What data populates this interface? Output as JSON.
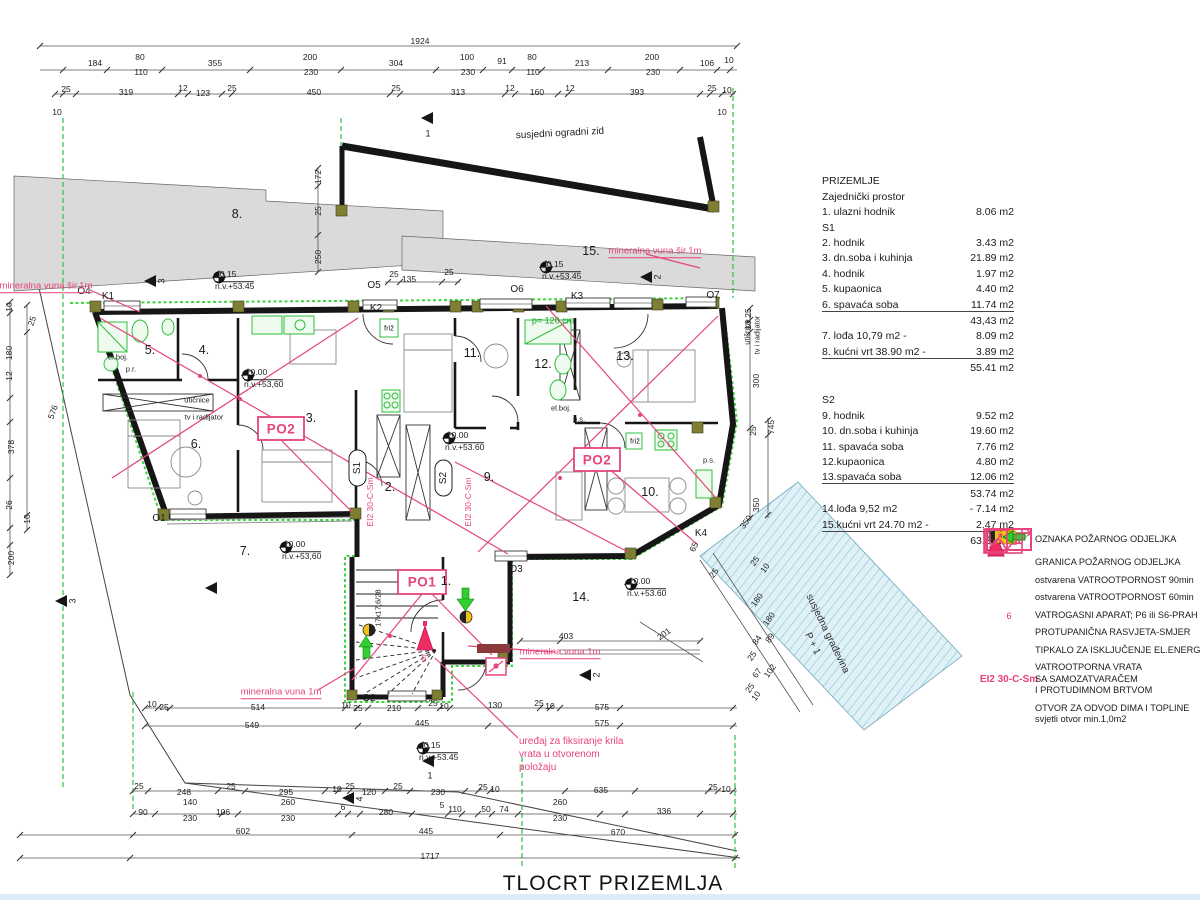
{
  "title": "TLOCRT PRIZEMLJA",
  "colors": {
    "pink": "#e5447c",
    "green": "#2fbf3f",
    "wall": "#161616",
    "gray_fill": "#dadada",
    "blue_fill": "#dff0f7",
    "blue_hatch": "#8cc3d6",
    "yellow": "#f2c117",
    "red": "#ec2e63",
    "olive": "#7f7f33"
  },
  "schedule": {
    "rows": [
      {
        "k": "h",
        "n": "PRIZEMLJE",
        "a": ""
      },
      {
        "k": "s",
        "n": "Zajednički prostor",
        "a": ""
      },
      {
        "k": "r",
        "n": "1. ulazni hodnik",
        "a": "8.06 m2"
      },
      {
        "k": "s",
        "n": "S1",
        "a": ""
      },
      {
        "k": "r",
        "n": "2. hodnik",
        "a": "3.43 m2"
      },
      {
        "k": "r",
        "n": "3. dn.soba i kuhinja",
        "a": "21.89 m2"
      },
      {
        "k": "r",
        "n": "4. hodnik",
        "a": "1.97 m2"
      },
      {
        "k": "r",
        "n": "5. kupaonica",
        "a": "4.40 m2"
      },
      {
        "k": "r",
        "n": "6. spavaća soba",
        "a": "11.74 m2",
        "u": 1
      },
      {
        "k": "t",
        "n": "",
        "a": "43,43 m2"
      },
      {
        "k": "r",
        "n": "7. lođa 10,79 m2 -",
        "a": "8.09 m2"
      },
      {
        "k": "r",
        "n": "8. kućni vrt 38.90 m2 -",
        "a": "3.89 m2",
        "u": 1
      },
      {
        "k": "t",
        "n": "",
        "a": "55.41 m2"
      },
      {
        "k": "gap",
        "n": "",
        "a": ""
      },
      {
        "k": "s",
        "n": "S2",
        "a": ""
      },
      {
        "k": "r",
        "n": "9. hodnik",
        "a": "9.52 m2"
      },
      {
        "k": "r",
        "n": "10. dn.soba i kuhinja",
        "a": "19.60 m2"
      },
      {
        "k": "r",
        "n": "11. spavaća soba",
        "a": "7.76 m2"
      },
      {
        "k": "r",
        "n": "12.kupaonica",
        "a": "4.80 m2"
      },
      {
        "k": "r",
        "n": "13.spavaća soba",
        "a": "12.06 m2",
        "u": 1
      },
      {
        "k": "t",
        "n": "",
        "a": "53.74 m2"
      },
      {
        "k": "r",
        "n": "14.lođa 9,52 m2",
        "a": "- 7.14 m2"
      },
      {
        "k": "r",
        "n": "15.kućni vrt 24.70 m2 -",
        "a": "2.47 m2",
        "u": 1
      },
      {
        "k": "t",
        "n": "",
        "a": "63.35 m2"
      }
    ]
  },
  "legend": {
    "items": [
      {
        "icon": "po1",
        "box_label": "PO1",
        "lines": [
          "OZNAKA POŽARNOG ODJELJKA"
        ]
      },
      {
        "icon": "boundary",
        "lines": [
          "GRANICA POŽARNOG ODJELJKA"
        ]
      },
      {
        "icon": "fire90",
        "lines": [
          "ostvarena VATROOTPORNOST 90min"
        ]
      },
      {
        "icon": "fire60",
        "lines": [
          "ostvarena  VATROOTPORNOST 60min"
        ]
      },
      {
        "icon": "extinguisher",
        "sub": "6",
        "lines": [
          "VATROGASNI APARAT; P6 ili S6-PRAH"
        ]
      },
      {
        "icon": "panic",
        "lines": [
          "PROTUPANIČNA RASVJETA-SMJER"
        ]
      },
      {
        "icon": "switch",
        "lines": [
          "TIPKALO ZA ISKLJUČENJE EL.ENERGIJE"
        ]
      },
      {
        "icon": "code",
        "code": "EI2 30-C-Sm",
        "lines": [
          "VATROOTPORNA VRATA",
          "SA SAMOZATVARAČEM",
          "I PROTUDIMNOM BRTVOM"
        ]
      },
      {
        "icon": "vent",
        "lines": [
          "OTVOR ZA ODVOD DIMA I TOPLINE",
          "svjetli otvor min.1,0m2"
        ]
      }
    ]
  },
  "elevations": [
    {
      "v": "-0.15",
      "nv": "n.v.+53.45",
      "x": 218,
      "y": 281
    },
    {
      "v": "-0.15",
      "nv": "n.v.+53.45",
      "x": 545,
      "y": 271
    },
    {
      "v": "±0.00",
      "nv": "n.v.+53,60",
      "x": 247,
      "y": 379
    },
    {
      "v": "±0.00",
      "nv": "n.v.+53.60",
      "x": 448,
      "y": 442
    },
    {
      "v": "±0.00",
      "nv": "n.v.+53.60",
      "x": 630,
      "y": 588
    },
    {
      "v": "±0.00",
      "nv": "n.v.+53,60",
      "x": 285,
      "y": 551
    },
    {
      "v": "-0.15",
      "nv": "n.v.+53.45",
      "x": 422,
      "y": 752
    }
  ],
  "plan_labels": [
    {
      "t": "1924",
      "x": 420,
      "y": 41,
      "c": "d"
    },
    {
      "t": "184",
      "x": 95,
      "y": 63,
      "c": "d"
    },
    {
      "t": "80",
      "x": 140,
      "y": 57,
      "c": "d"
    },
    {
      "t": "110",
      "x": 141,
      "y": 72,
      "c": "d"
    },
    {
      "t": "355",
      "x": 215,
      "y": 63,
      "c": "d"
    },
    {
      "t": "200",
      "x": 310,
      "y": 57,
      "c": "d"
    },
    {
      "t": "230",
      "x": 311,
      "y": 72,
      "c": "d"
    },
    {
      "t": "304",
      "x": 396,
      "y": 63,
      "c": "d"
    },
    {
      "t": "100",
      "x": 467,
      "y": 57,
      "c": "d"
    },
    {
      "t": "230",
      "x": 468,
      "y": 72,
      "c": "d"
    },
    {
      "t": "91",
      "x": 502,
      "y": 61,
      "c": "d"
    },
    {
      "t": "80",
      "x": 532,
      "y": 57,
      "c": "d"
    },
    {
      "t": "110",
      "x": 533,
      "y": 72,
      "c": "d"
    },
    {
      "t": "213",
      "x": 582,
      "y": 63,
      "c": "d"
    },
    {
      "t": "200",
      "x": 652,
      "y": 57,
      "c": "d"
    },
    {
      "t": "230",
      "x": 653,
      "y": 72,
      "c": "d"
    },
    {
      "t": "106",
      "x": 707,
      "y": 63,
      "c": "d"
    },
    {
      "t": "10",
      "x": 729,
      "y": 60,
      "c": "d"
    },
    {
      "t": "25",
      "x": 66,
      "y": 89,
      "c": "d"
    },
    {
      "t": "319",
      "x": 126,
      "y": 92,
      "c": "d"
    },
    {
      "t": "12",
      "x": 183,
      "y": 88,
      "c": "d"
    },
    {
      "t": "123",
      "x": 203,
      "y": 93,
      "c": "d"
    },
    {
      "t": "25",
      "x": 232,
      "y": 88,
      "c": "d"
    },
    {
      "t": "450",
      "x": 314,
      "y": 92,
      "c": "d"
    },
    {
      "t": "25",
      "x": 396,
      "y": 88,
      "c": "d"
    },
    {
      "t": "313",
      "x": 458,
      "y": 92,
      "c": "d"
    },
    {
      "t": "12",
      "x": 510,
      "y": 88,
      "c": "d"
    },
    {
      "t": "160",
      "x": 537,
      "y": 92,
      "c": "d"
    },
    {
      "t": "12",
      "x": 570,
      "y": 88,
      "c": "d"
    },
    {
      "t": "393",
      "x": 637,
      "y": 92,
      "c": "d"
    },
    {
      "t": "25",
      "x": 712,
      "y": 88,
      "c": "d"
    },
    {
      "t": "10",
      "x": 727,
      "y": 90,
      "c": "d"
    },
    {
      "t": "10",
      "x": 57,
      "y": 112,
      "c": "d"
    },
    {
      "t": "10",
      "x": 722,
      "y": 112,
      "c": "d"
    },
    {
      "t": "25",
      "x": 139,
      "y": 786,
      "c": "d"
    },
    {
      "t": "248",
      "x": 184,
      "y": 792,
      "c": "d"
    },
    {
      "t": "25",
      "x": 231,
      "y": 786,
      "c": "d"
    },
    {
      "t": "295",
      "x": 286,
      "y": 792,
      "c": "d"
    },
    {
      "t": "10",
      "x": 337,
      "y": 789,
      "c": "d"
    },
    {
      "t": "25",
      "x": 350,
      "y": 786,
      "c": "d"
    },
    {
      "t": "120",
      "x": 369,
      "y": 792,
      "c": "d"
    },
    {
      "t": "25",
      "x": 398,
      "y": 786,
      "c": "d"
    },
    {
      "t": "230",
      "x": 438,
      "y": 792,
      "c": "d"
    },
    {
      "t": "25",
      "x": 483,
      "y": 787,
      "c": "d"
    },
    {
      "t": "10",
      "x": 495,
      "y": 789,
      "c": "d"
    },
    {
      "t": "635",
      "x": 601,
      "y": 790,
      "c": "d"
    },
    {
      "t": "25",
      "x": 713,
      "y": 787,
      "c": "d"
    },
    {
      "t": "10",
      "x": 726,
      "y": 789,
      "c": "d"
    },
    {
      "t": "90",
      "x": 143,
      "y": 812,
      "c": "d"
    },
    {
      "t": "140",
      "x": 190,
      "y": 802,
      "c": "d"
    },
    {
      "t": "230",
      "x": 190,
      "y": 818,
      "c": "d"
    },
    {
      "t": "106",
      "x": 223,
      "y": 812,
      "c": "d"
    },
    {
      "t": "260",
      "x": 288,
      "y": 802,
      "c": "d"
    },
    {
      "t": "230",
      "x": 288,
      "y": 818,
      "c": "d"
    },
    {
      "t": "6",
      "x": 343,
      "y": 807,
      "c": "d"
    },
    {
      "t": "280",
      "x": 386,
      "y": 812,
      "c": "d"
    },
    {
      "t": "5",
      "x": 442,
      "y": 805,
      "c": "d"
    },
    {
      "t": "110",
      "x": 455,
      "y": 809,
      "c": "d"
    },
    {
      "t": "50",
      "x": 486,
      "y": 809,
      "c": "d"
    },
    {
      "t": "74",
      "x": 504,
      "y": 809,
      "c": "d"
    },
    {
      "t": "260",
      "x": 560,
      "y": 802,
      "c": "d"
    },
    {
      "t": "230",
      "x": 560,
      "y": 818,
      "c": "d"
    },
    {
      "t": "336",
      "x": 664,
      "y": 811,
      "c": "d"
    },
    {
      "t": "602",
      "x": 243,
      "y": 831,
      "c": "d"
    },
    {
      "t": "445",
      "x": 426,
      "y": 831,
      "c": "d"
    },
    {
      "t": "670",
      "x": 618,
      "y": 832,
      "c": "d"
    },
    {
      "t": "1717",
      "x": 430,
      "y": 856,
      "c": "d"
    },
    {
      "t": "10",
      "x": 152,
      "y": 704,
      "c": "d"
    },
    {
      "t": "25",
      "x": 164,
      "y": 707,
      "c": "d"
    },
    {
      "t": "514",
      "x": 258,
      "y": 707,
      "c": "d"
    },
    {
      "t": "549",
      "x": 252,
      "y": 725,
      "c": "d"
    },
    {
      "t": "10",
      "x": 346,
      "y": 705,
      "c": "d"
    },
    {
      "t": "25",
      "x": 358,
      "y": 708,
      "c": "d"
    },
    {
      "t": "210",
      "x": 394,
      "y": 708,
      "c": "d"
    },
    {
      "t": "25",
      "x": 433,
      "y": 703,
      "c": "d"
    },
    {
      "t": "10",
      "x": 444,
      "y": 706,
      "c": "d"
    },
    {
      "t": "130",
      "x": 495,
      "y": 705,
      "c": "d"
    },
    {
      "t": "25",
      "x": 539,
      "y": 703,
      "c": "d"
    },
    {
      "t": "10",
      "x": 550,
      "y": 706,
      "c": "d"
    },
    {
      "t": "575",
      "x": 602,
      "y": 707,
      "c": "d"
    },
    {
      "t": "445",
      "x": 422,
      "y": 723,
      "c": "d"
    },
    {
      "t": "575",
      "x": 602,
      "y": 723,
      "c": "d"
    },
    {
      "t": "403",
      "x": 566,
      "y": 636,
      "c": "d"
    },
    {
      "t": "201",
      "x": 664,
      "y": 634,
      "c": "ds",
      "r": -35
    },
    {
      "t": "10",
      "x": 9,
      "y": 307,
      "c": "dv"
    },
    {
      "t": "180",
      "x": 9,
      "y": 353,
      "c": "dv"
    },
    {
      "t": "12",
      "x": 9,
      "y": 376,
      "c": "dv"
    },
    {
      "t": "378",
      "x": 11,
      "y": 447,
      "c": "dv"
    },
    {
      "t": "26",
      "x": 9,
      "y": 505,
      "c": "dv"
    },
    {
      "t": "10",
      "x": 27,
      "y": 519,
      "c": "dv"
    },
    {
      "t": "200",
      "x": 11,
      "y": 558,
      "c": "dv"
    },
    {
      "t": "576",
      "x": 53,
      "y": 412,
      "c": "ds",
      "r": -70
    },
    {
      "t": "25",
      "x": 32,
      "y": 321,
      "c": "ds",
      "r": -70
    },
    {
      "t": "172",
      "x": 318,
      "y": 177,
      "c": "dv"
    },
    {
      "t": "25",
      "x": 318,
      "y": 211,
      "c": "dv"
    },
    {
      "t": "250",
      "x": 318,
      "y": 257,
      "c": "dv"
    },
    {
      "t": "25",
      "x": 394,
      "y": 274,
      "c": "d"
    },
    {
      "t": "135",
      "x": 409,
      "y": 279,
      "c": "d"
    },
    {
      "t": "25",
      "x": 449,
      "y": 272,
      "c": "d"
    },
    {
      "t": "25",
      "x": 748,
      "y": 313,
      "c": "dv"
    },
    {
      "t": "10",
      "x": 748,
      "y": 325,
      "c": "dv"
    },
    {
      "t": "300",
      "x": 756,
      "y": 381,
      "c": "dv"
    },
    {
      "t": "25",
      "x": 753,
      "y": 431,
      "c": "dv"
    },
    {
      "t": "745",
      "x": 771,
      "y": 427,
      "c": "dv"
    },
    {
      "t": "350",
      "x": 756,
      "y": 505,
      "c": "dv"
    },
    {
      "t": "K4",
      "x": 701,
      "y": 534,
      "c": "k"
    },
    {
      "t": "65",
      "x": 694,
      "y": 547,
      "c": "ds",
      "r": -62
    },
    {
      "t": "350",
      "x": 746,
      "y": 522,
      "c": "ds",
      "r": -55
    },
    {
      "t": "25",
      "x": 714,
      "y": 573,
      "c": "ds",
      "r": -55
    },
    {
      "t": "25",
      "x": 755,
      "y": 561,
      "c": "ds",
      "r": -55
    },
    {
      "t": "10",
      "x": 765,
      "y": 568,
      "c": "ds",
      "r": -55
    },
    {
      "t": "180",
      "x": 757,
      "y": 600,
      "c": "ds",
      "r": -55
    },
    {
      "t": "180",
      "x": 769,
      "y": 619,
      "c": "ds",
      "r": -55
    },
    {
      "t": "84",
      "x": 757,
      "y": 640,
      "c": "ds",
      "r": -55
    },
    {
      "t": "89",
      "x": 770,
      "y": 638,
      "c": "ds",
      "r": -55
    },
    {
      "t": "25",
      "x": 752,
      "y": 656,
      "c": "ds",
      "r": -55
    },
    {
      "t": "67",
      "x": 757,
      "y": 673,
      "c": "ds",
      "r": -55
    },
    {
      "t": "102",
      "x": 770,
      "y": 671,
      "c": "ds",
      "r": -55
    },
    {
      "t": "25",
      "x": 750,
      "y": 688,
      "c": "ds",
      "r": -55
    },
    {
      "t": "10",
      "x": 756,
      "y": 696,
      "c": "ds",
      "r": -55
    },
    {
      "t": "8.",
      "x": 237,
      "y": 214,
      "c": "r"
    },
    {
      "t": "15.",
      "x": 591,
      "y": 251,
      "c": "r"
    },
    {
      "t": "5.",
      "x": 150,
      "y": 350,
      "c": "r"
    },
    {
      "t": "4.",
      "x": 204,
      "y": 350,
      "c": "r"
    },
    {
      "t": "3.",
      "x": 311,
      "y": 418,
      "c": "r"
    },
    {
      "t": "6.",
      "x": 196,
      "y": 444,
      "c": "r"
    },
    {
      "t": "2.",
      "x": 390,
      "y": 487,
      "c": "r"
    },
    {
      "t": "7.",
      "x": 245,
      "y": 551,
      "c": "r"
    },
    {
      "t": "9.",
      "x": 489,
      "y": 477,
      "c": "r"
    },
    {
      "t": "11.",
      "x": 472,
      "y": 353,
      "c": "r"
    },
    {
      "t": "12.",
      "x": 543,
      "y": 364,
      "c": "r"
    },
    {
      "t": "13.",
      "x": 625,
      "y": 356,
      "c": "r"
    },
    {
      "t": "10.",
      "x": 650,
      "y": 492,
      "c": "r"
    },
    {
      "t": "14.",
      "x": 581,
      "y": 597,
      "c": "r"
    },
    {
      "t": "1.",
      "x": 446,
      "y": 581,
      "c": "r"
    },
    {
      "t": "O4",
      "x": 84,
      "y": 292,
      "c": "k"
    },
    {
      "t": "K1",
      "x": 108,
      "y": 297,
      "c": "k"
    },
    {
      "t": "O5",
      "x": 374,
      "y": 286,
      "c": "k"
    },
    {
      "t": "K2",
      "x": 376,
      "y": 309,
      "c": "k"
    },
    {
      "t": "O6",
      "x": 517,
      "y": 290,
      "c": "k"
    },
    {
      "t": "K3",
      "x": 577,
      "y": 297,
      "c": "k"
    },
    {
      "t": "O7",
      "x": 713,
      "y": 296,
      "c": "k"
    },
    {
      "t": "O1",
      "x": 159,
      "y": 519,
      "c": "k"
    },
    {
      "t": "O2",
      "x": 369,
      "y": 699,
      "c": "k"
    },
    {
      "t": "O3",
      "x": 516,
      "y": 570,
      "c": "k"
    },
    {
      "t": "mineralna vuna šir.1m",
      "x": 46,
      "y": 287,
      "c": "pu"
    },
    {
      "t": "mineralna vuna šir.1m",
      "x": 655,
      "y": 252,
      "c": "pu"
    },
    {
      "t": "mineralna vuna 1m",
      "x": 560,
      "y": 653,
      "c": "pu"
    },
    {
      "t": "mineralna vuna 1m",
      "x": 281,
      "y": 693,
      "c": "pu"
    },
    {
      "t": "PO2",
      "x": 281,
      "y": 429,
      "c": "po"
    },
    {
      "t": "PO1",
      "x": 422,
      "y": 582,
      "c": "po"
    },
    {
      "t": "PO2",
      "x": 597,
      "y": 460,
      "c": "po"
    },
    {
      "t": "EI2 30-C-Sm",
      "x": 370,
      "y": 502,
      "c": "pv"
    },
    {
      "t": "EI2 30-C-Sm",
      "x": 468,
      "y": 502,
      "c": "pv"
    },
    {
      "t": "6",
      "x": 424,
      "y": 659,
      "c": "p"
    },
    {
      "t": "uređaj za fiksiranje krila\nvrata u otvorenom\npoložaju",
      "x": 519,
      "y": 735,
      "c": "pnote"
    },
    {
      "t": "p= 120 cm",
      "x": 553,
      "y": 321,
      "c": "g"
    },
    {
      "t": "el.boj.",
      "x": 118,
      "y": 357,
      "c": "s"
    },
    {
      "t": "p.r.",
      "x": 131,
      "y": 369,
      "c": "s"
    },
    {
      "t": "utičnice",
      "x": 197,
      "y": 400,
      "c": "s"
    },
    {
      "t": "tv i radijator",
      "x": 204,
      "y": 417,
      "c": "s"
    },
    {
      "t": "el.boj.",
      "x": 561,
      "y": 408,
      "c": "s"
    },
    {
      "t": "p.s.",
      "x": 579,
      "y": 419,
      "c": "s"
    },
    {
      "t": "friž",
      "x": 389,
      "y": 328,
      "c": "s"
    },
    {
      "t": "friž",
      "x": 635,
      "y": 441,
      "c": "s"
    },
    {
      "t": "p.s.",
      "x": 709,
      "y": 460,
      "c": "s"
    },
    {
      "t": "utičnice",
      "x": 747,
      "y": 332,
      "c": "sv"
    },
    {
      "t": "tv i radijator",
      "x": 757,
      "y": 335,
      "c": "sv"
    },
    {
      "t": "17x17,6/28",
      "x": 378,
      "y": 608,
      "c": "sv"
    },
    {
      "t": "S1",
      "x": 358,
      "y": 468,
      "c": "sov"
    },
    {
      "t": "S2",
      "x": 444,
      "y": 478,
      "c": "sov"
    },
    {
      "t": "susjedni ogradni zid",
      "x": 560,
      "y": 134,
      "c": "n",
      "r": -3
    },
    {
      "t": "susjedna građevina",
      "x": 827,
      "y": 634,
      "c": "gn",
      "r": 64
    },
    {
      "t": "P + 1",
      "x": 812,
      "y": 644,
      "c": "gn",
      "r": 64
    },
    {
      "t": "1",
      "x": 428,
      "y": 134,
      "c": "t"
    },
    {
      "t": "3",
      "x": 162,
      "y": 281,
      "c": "tv"
    },
    {
      "t": "2",
      "x": 658,
      "y": 277,
      "c": "tv"
    },
    {
      "t": "2",
      "x": 597,
      "y": 675,
      "c": "tv"
    },
    {
      "t": "3",
      "x": 73,
      "y": 601,
      "c": "tv"
    },
    {
      "t": "4",
      "x": 360,
      "y": 799,
      "c": "tv"
    },
    {
      "t": "1",
      "x": 430,
      "y": 776,
      "c": "t"
    }
  ]
}
